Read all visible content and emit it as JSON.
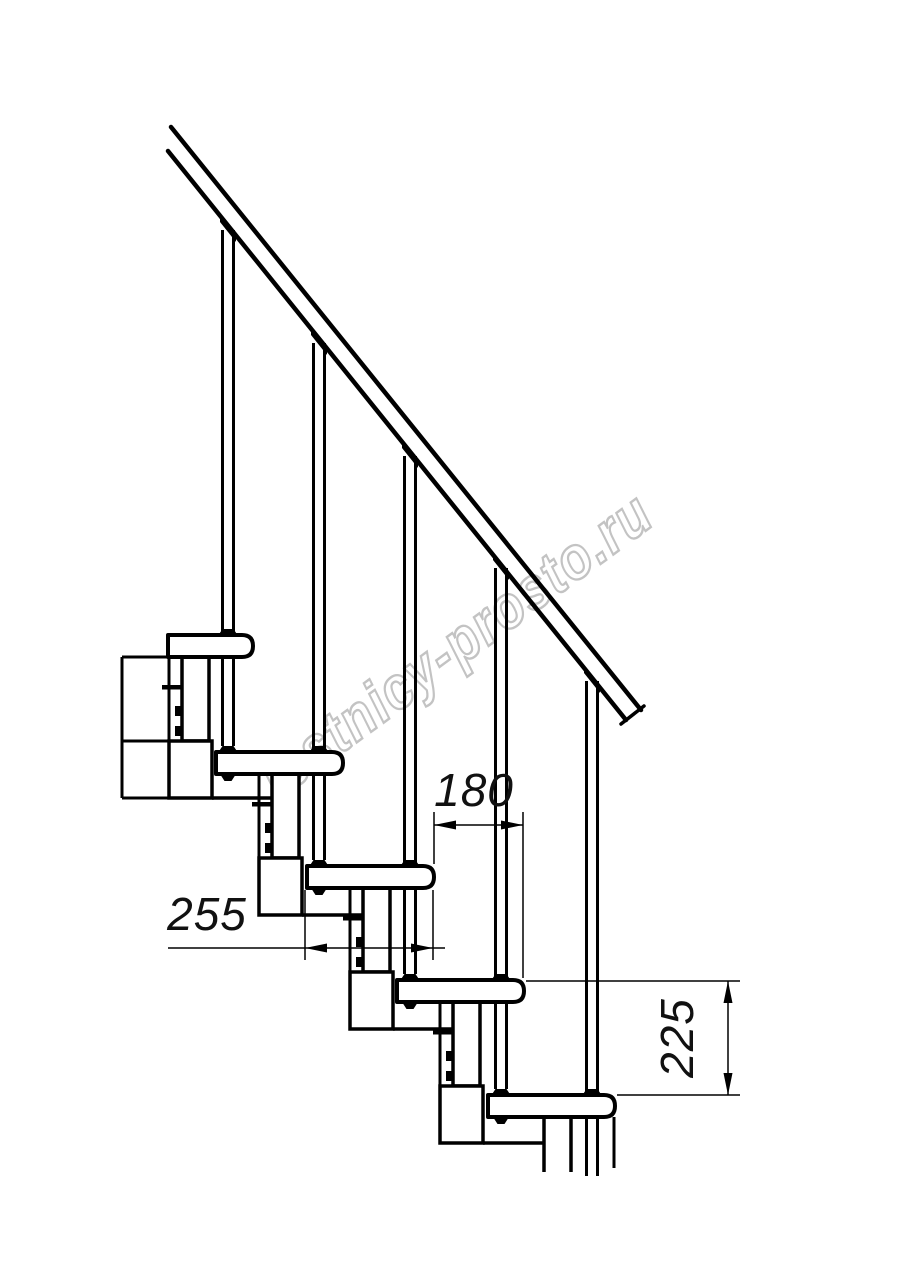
{
  "watermark": {
    "text": "lestnicy-prosto.ru",
    "color": "#c3c3c3"
  },
  "drawing": {
    "subject": "modular staircase side elevation with handrail, balusters and central stringer modules",
    "line_color": "#000000",
    "background": "#ffffff",
    "step_count": 5,
    "baluster_count": 5,
    "dimensions": [
      {
        "id": "going",
        "label": "180",
        "orientation": "horizontal",
        "meaning": "step going between tread noses"
      },
      {
        "id": "tread-depth",
        "label": "255",
        "orientation": "horizontal",
        "meaning": "tread depth"
      },
      {
        "id": "rise",
        "label": "225",
        "orientation": "vertical",
        "meaning": "step rise between treads"
      }
    ]
  }
}
